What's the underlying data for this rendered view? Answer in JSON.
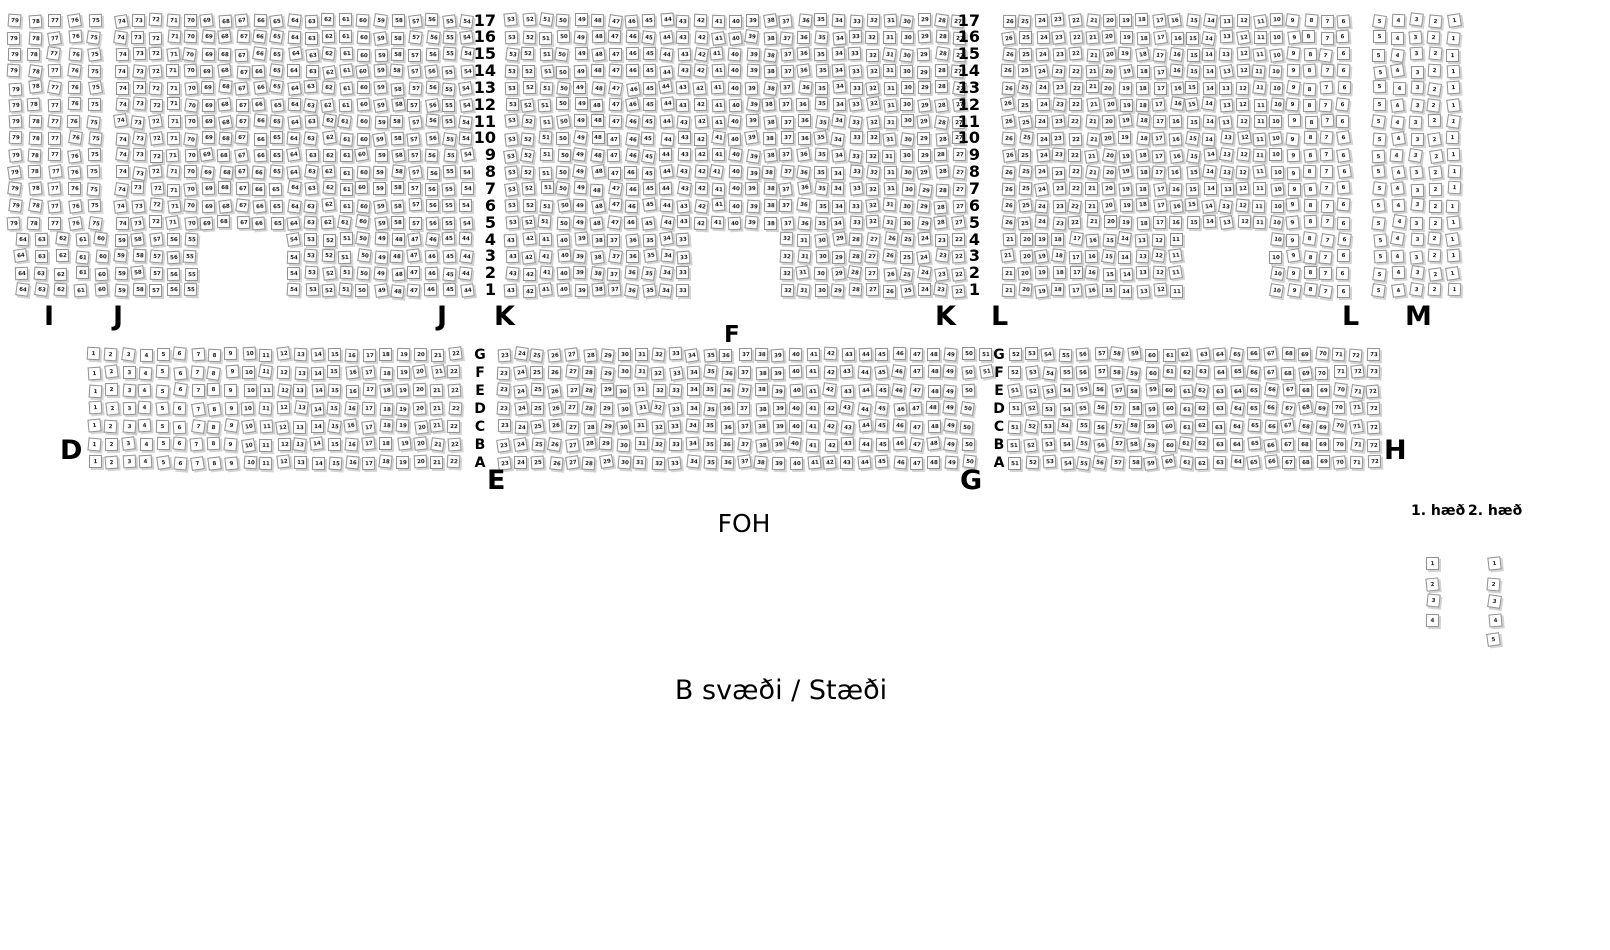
{
  "canvas": {
    "width": 1610,
    "height": 950,
    "background": "#ffffff"
  },
  "seat_style": {
    "fill": "#ffffff",
    "border": "#8f8f8f",
    "shadow": "#d3d3d3",
    "number_color": "#1a1a1a",
    "size": 13
  },
  "annotations": {
    "foh": "FOH",
    "b_area": "B svæði / Stæði",
    "floor1": "1. hæð",
    "floor2": "2. hæð"
  },
  "upper_tier": {
    "y_top": 14,
    "row_pitch": 16.85,
    "full_row_count": 13,
    "short_row_count": 4,
    "row_numbers": [
      "17",
      "16",
      "15",
      "14",
      "13",
      "12",
      "11",
      "10",
      "9",
      "8",
      "7",
      "6",
      "5",
      "4",
      "3",
      "2",
      "1"
    ],
    "row_number_columns_x": [
      496,
      980
    ],
    "sections": [
      {
        "label": "I",
        "x": 8,
        "col_pitch": 20.0,
        "full_rows": {
          "from": 79,
          "to": 75
        },
        "short_rows": {
          "x_shift": 7,
          "groups": [
            {
              "from": 64,
              "to": 60,
              "col": 0
            }
          ]
        }
      },
      {
        "label": "J",
        "x": 115,
        "col_pitch": 17.25,
        "full_rows": {
          "from": 74,
          "to": 54
        },
        "short_rows": {
          "x_shift": 0,
          "groups": [
            {
              "from": 59,
              "to": 55,
              "col": 0
            },
            {
              "from": 54,
              "to": 44,
              "col": 10
            }
          ]
        }
      },
      {
        "label": "K",
        "x": 505,
        "col_pitch": 17.2,
        "full_rows": {
          "from": 53,
          "to": 27
        },
        "short_rows": {
          "x_shift": 0,
          "groups": [
            {
              "from": 43,
              "to": 33,
              "col": 0
            },
            {
              "from": 32,
              "to": 22,
              "col": 16
            }
          ]
        }
      },
      {
        "label": "L",
        "x": 1002,
        "col_pitch": 16.75,
        "full_rows": {
          "from": 26,
          "to": 6
        },
        "short_rows": {
          "x_shift": 0,
          "groups": [
            {
              "from": 21,
              "to": 11,
              "col": 0
            },
            {
              "from": 10,
              "to": 6,
              "col": 16
            }
          ]
        }
      },
      {
        "label": "M",
        "x": 1373,
        "col_pitch": 18.5,
        "full_rows": {
          "from": 5,
          "to": 1
        },
        "short_rows": {
          "x_shift": 0,
          "groups": [
            {
              "from": 5,
              "to": 1,
              "col": 0
            }
          ]
        }
      }
    ],
    "section_labels": [
      {
        "text": "I",
        "x": 44,
        "y": 303,
        "small": false
      },
      {
        "text": "J",
        "x": 113,
        "y": 303,
        "small": false
      },
      {
        "text": "J",
        "x": 437,
        "y": 303,
        "small": false
      },
      {
        "text": "K",
        "x": 494,
        "y": 303,
        "small": false
      },
      {
        "text": "F",
        "x": 724,
        "y": 324,
        "small": true
      },
      {
        "text": "K",
        "x": 935,
        "y": 303,
        "small": false
      },
      {
        "text": "L",
        "x": 991,
        "y": 303,
        "small": false
      },
      {
        "text": "L",
        "x": 1342,
        "y": 303,
        "small": false
      },
      {
        "text": "M",
        "x": 1405,
        "y": 303,
        "small": false
      }
    ]
  },
  "mid_tier": {
    "y_top": 348,
    "row_pitch": 18.0,
    "row_letters": [
      "G",
      "F",
      "E",
      "D",
      "C",
      "B",
      "A"
    ],
    "letter_columns_x": [
      480,
      999
    ],
    "sections": [
      {
        "label": "D",
        "x": 88,
        "col_pitch": 17.15,
        "rows_top2": {
          "from": 1,
          "to": 22
        },
        "rows_rest": {
          "from": 1,
          "to": 22
        }
      },
      {
        "label": "E",
        "x": 497,
        "col_pitch": 17.2,
        "rows_top2": {
          "from": 23,
          "to": 51
        },
        "rows_rest": {
          "from": 23,
          "to": 50
        }
      },
      {
        "label": "G",
        "x": 1008,
        "col_pitch": 17.1,
        "rows_top2": {
          "from": 52,
          "to": 73
        },
        "rows_rest": {
          "from": 51,
          "to": 72
        }
      }
    ],
    "section_labels": [
      {
        "text": "D",
        "x": 60,
        "y": 437,
        "small": false
      },
      {
        "text": "E",
        "x": 487,
        "y": 467,
        "small": false
      },
      {
        "text": "G",
        "x": 960,
        "y": 467,
        "small": false
      },
      {
        "text": "H",
        "x": 1384,
        "y": 437,
        "small": false
      }
    ]
  },
  "balcony": {
    "columns": [
      {
        "name": "1. hæð",
        "x": 1427,
        "y_top": 558,
        "row_pitch": 18.5,
        "seats": [
          "1",
          "2",
          "3",
          "4"
        ]
      },
      {
        "name": "2. hæð",
        "x": 1488,
        "y_top": 558,
        "row_pitch": 18.5,
        "seats": [
          "1",
          "2",
          "3",
          "4",
          "5"
        ]
      }
    ]
  }
}
